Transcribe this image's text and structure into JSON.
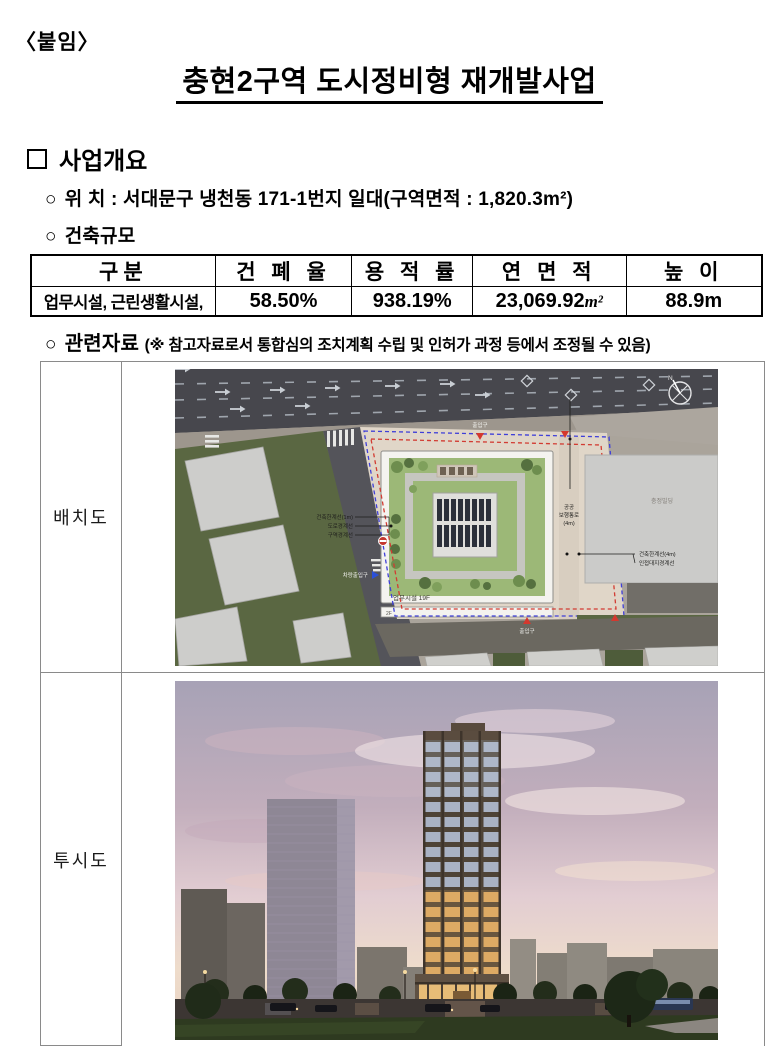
{
  "page": {
    "attachment_label": "〈붙임〉",
    "title": "충현2구역 도시정비형 재개발사업"
  },
  "overview": {
    "box_marker": "□",
    "heading": "사업개요",
    "bullet_marker": "○",
    "location_line": "위  치 : 서대문구 냉천동 171-1번지 일대(구역면적 : 1,820.3m²)",
    "scale_heading": "건축규모"
  },
  "scale_table": {
    "headers": [
      "구분",
      "건 폐 율",
      "용 적 률",
      "연 면 적",
      "높 이"
    ],
    "row": {
      "gubun": "업무시설, 근린생활시설,",
      "coverage": "58.50%",
      "far": "938.19%",
      "floor_area_value": "23,069.92",
      "floor_area_unit": "m²",
      "height": "88.9m"
    }
  },
  "related": {
    "heading": "관련자료",
    "note": "(※ 참고자료로서 통합심의 조치계획 수립 및 인허가 과정 등에서 조정될 수 있음)"
  },
  "figures": {
    "site_plan": {
      "label": "배치도",
      "annotations": {
        "north": "N",
        "biz": "업무시설 19F",
        "f2": "2F",
        "ped1": "공공",
        "ped2": "보행통로",
        "ped3": "(4m)",
        "lim4": "건축한계선(4m)",
        "adj": "인접대지경계선",
        "lim1": "건축한계선(1m)",
        "roadline": "도로경계선",
        "zoneline": "구역경계선",
        "bldg": "충정빌딩",
        "ent_top": "출입구",
        "ent_bottom": "출입구",
        "car_ent": "차량출입구"
      }
    },
    "perspective": {
      "label": "투시도"
    }
  },
  "colors": {
    "boundary_blue": "#3f3fd8",
    "boundary_red": "#d23b32",
    "roof_green": "#9cb877",
    "window_warm": "#d9a763",
    "window_cool": "#a9b2c4",
    "tower_frame": "#4e4337"
  }
}
